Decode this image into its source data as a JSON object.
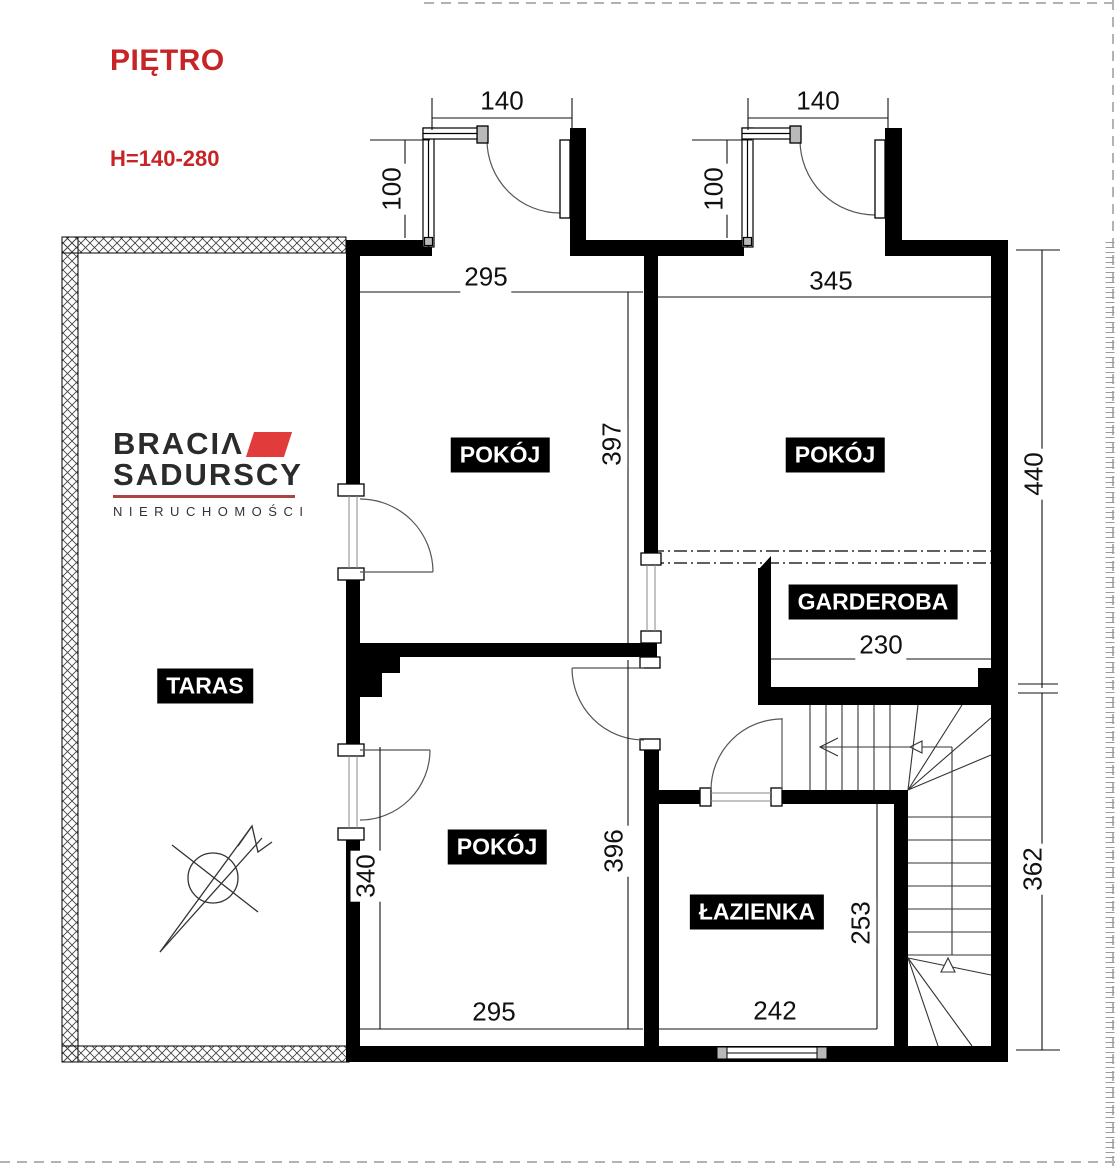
{
  "title": "PIĘTRO",
  "height_note": "H=140-280",
  "logo": {
    "brand_top": "BRACIΛ",
    "brand_bottom": "SADURSCY",
    "tagline": "NIERUCHOMOŚCI"
  },
  "rooms": {
    "pokoj_top_left": "POKÓJ",
    "pokoj_top_right": "POKÓJ",
    "pokoj_bottom": "POKÓJ",
    "garderoba": "GARDEROBA",
    "lazienka": "ŁAZIENKA",
    "taras": "TARAS"
  },
  "dims": {
    "balcony_left_width": "140",
    "balcony_right_width": "140",
    "balcony_left_depth": "100",
    "balcony_right_depth": "100",
    "pokoj_top_left_width": "295",
    "pokoj_top_left_height": "397",
    "pokoj_top_right_width": "345",
    "right_side_upper_height": "440",
    "garderoba_width": "230",
    "pokoj_bottom_left_height": "340",
    "pokoj_bottom_height": "396",
    "pokoj_bottom_width": "295",
    "lazienka_height": "253",
    "lazienka_width": "242",
    "right_side_lower_height": "362"
  },
  "icons": {
    "north_arrow": "north-arrow-icon"
  },
  "colors": {
    "wall": "#000000",
    "accent_red": "#c62427",
    "logo_red": "#e23b3b",
    "label_bg": "#000000",
    "label_text": "#ffffff"
  }
}
